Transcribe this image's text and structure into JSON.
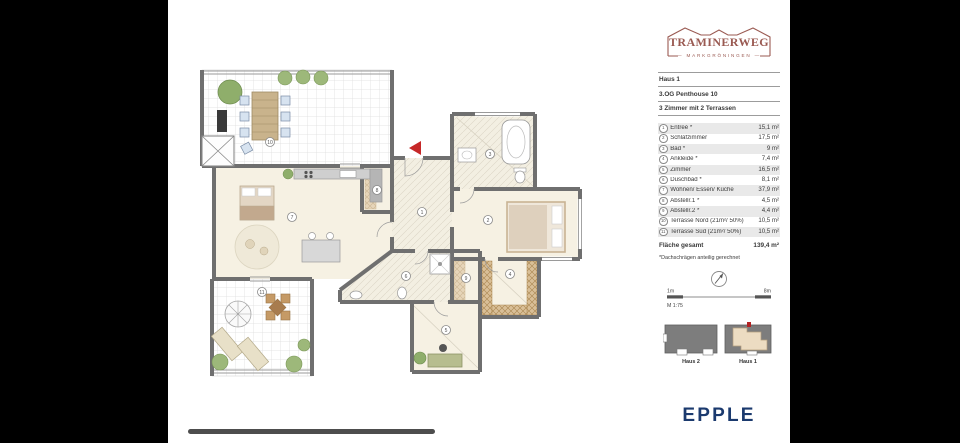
{
  "logo": {
    "title": "TRAMINERWEG",
    "subtitle": "MARKGRÖNINGEN",
    "color": "#9a5a52"
  },
  "project": {
    "house": "Haus 1",
    "floor_unit": "3.OG  Penthouse 10",
    "layout": "3 Zimmer mit 2 Terrassen"
  },
  "legend": {
    "rows": [
      {
        "num": "1",
        "label": "Entreé *",
        "area": "15,1 m²"
      },
      {
        "num": "2",
        "label": "Schlafzimmer",
        "area": "17,5 m²"
      },
      {
        "num": "3",
        "label": "Bad *",
        "area": "9 m²"
      },
      {
        "num": "4",
        "label": "Ankleide *",
        "area": "7,4 m²"
      },
      {
        "num": "5",
        "label": "Zimmer",
        "area": "16,5 m²"
      },
      {
        "num": "6",
        "label": "Duschbad *",
        "area": "8,1 m²"
      },
      {
        "num": "7",
        "label": "Wohnen/ Essen/ Küche",
        "area": "37,9 m²"
      },
      {
        "num": "8",
        "label": "Abstellr.1 *",
        "area": "4,5 m²"
      },
      {
        "num": "9",
        "label": "Abstellr.2 *",
        "area": "4,4 m²"
      },
      {
        "num": "10",
        "label": "Terrasse Nord (21m²/ 50%)",
        "area": "10,5 m²"
      },
      {
        "num": "11",
        "label": "Terrasse Süd (21m²/ 50%)",
        "area": "10,5 m²"
      }
    ],
    "total_label": "Fläche gesamt",
    "total_area": "139,4 m²",
    "footnote": "*Dachschrägen anteilig gerechnet"
  },
  "scale": {
    "left": "1m",
    "right": "8m",
    "ratio": "M 1:75"
  },
  "keyplan": {
    "left_label": "Haus 2",
    "right_label": "Haus 1"
  },
  "brand": {
    "name": "EPPLE",
    "color": "#1b3a6e"
  },
  "colors": {
    "wall": "#6f6f6f",
    "floor": "#f6f1e3",
    "wardrobe_hatch": "#d9bf97",
    "entry_arrow": "#c62828",
    "stripe": "#e9e9e9",
    "side_bars": "#000000"
  }
}
